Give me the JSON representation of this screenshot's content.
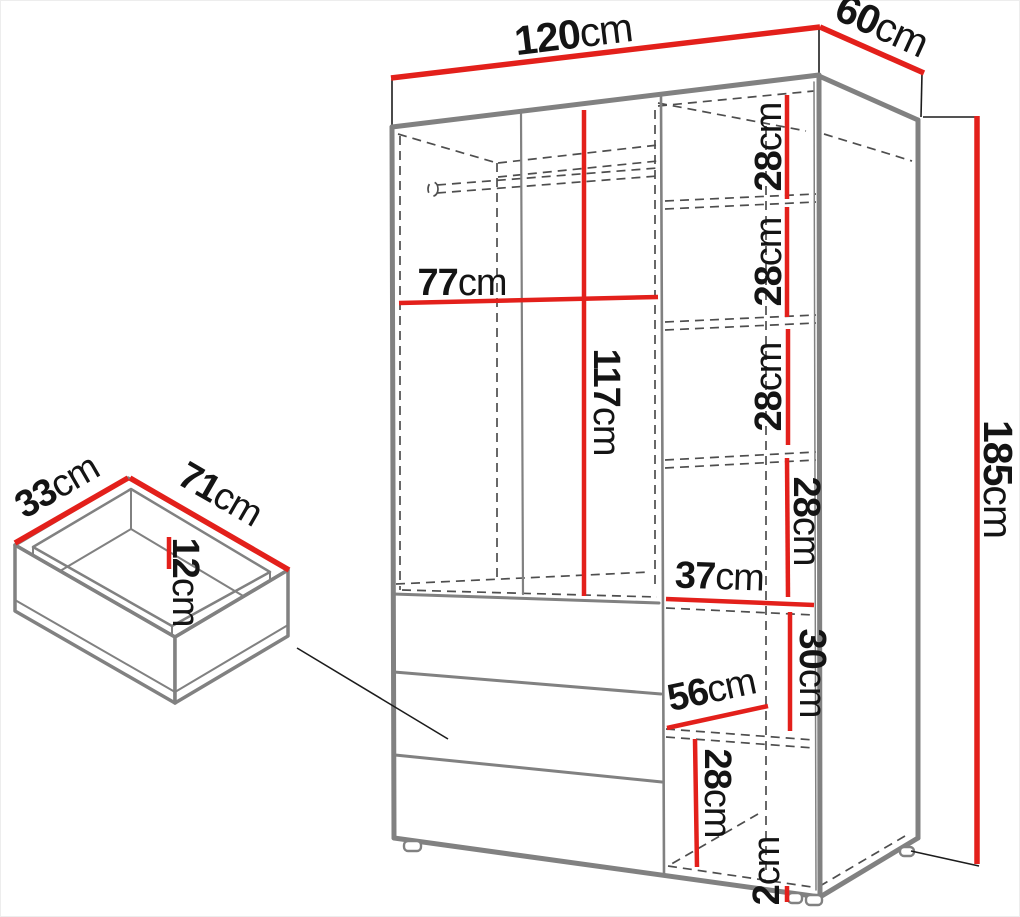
{
  "colors": {
    "dimension_line": "#e3201b",
    "outline": "#818181",
    "hidden_line": "#4e4e4e",
    "text": "#141414",
    "background": "#ffffff"
  },
  "wardrobe": {
    "width": {
      "value": "120",
      "unit": "cm"
    },
    "depth": {
      "value": "60",
      "unit": "cm"
    },
    "height": {
      "value": "185",
      "unit": "cm"
    },
    "interior_width": {
      "value": "77",
      "unit": "cm"
    },
    "interior_height": {
      "value": "117",
      "unit": "cm"
    },
    "right_column_width": {
      "value": "37",
      "unit": "cm"
    },
    "shelf_spacings": [
      {
        "value": "28",
        "unit": "cm"
      },
      {
        "value": "28",
        "unit": "cm"
      },
      {
        "value": "28",
        "unit": "cm"
      },
      {
        "value": "28",
        "unit": "cm"
      }
    ],
    "lower_compartment_height": {
      "value": "30",
      "unit": "cm"
    },
    "drawer_front_width": {
      "value": "56",
      "unit": "cm"
    },
    "bottom_compartment_height": {
      "value": "28",
      "unit": "cm"
    },
    "base_height": {
      "value": "2",
      "unit": "cm"
    }
  },
  "drawer_detail": {
    "depth": {
      "value": "33",
      "unit": "cm"
    },
    "width": {
      "value": "71",
      "unit": "cm"
    },
    "height": {
      "value": "12",
      "unit": "cm"
    }
  }
}
